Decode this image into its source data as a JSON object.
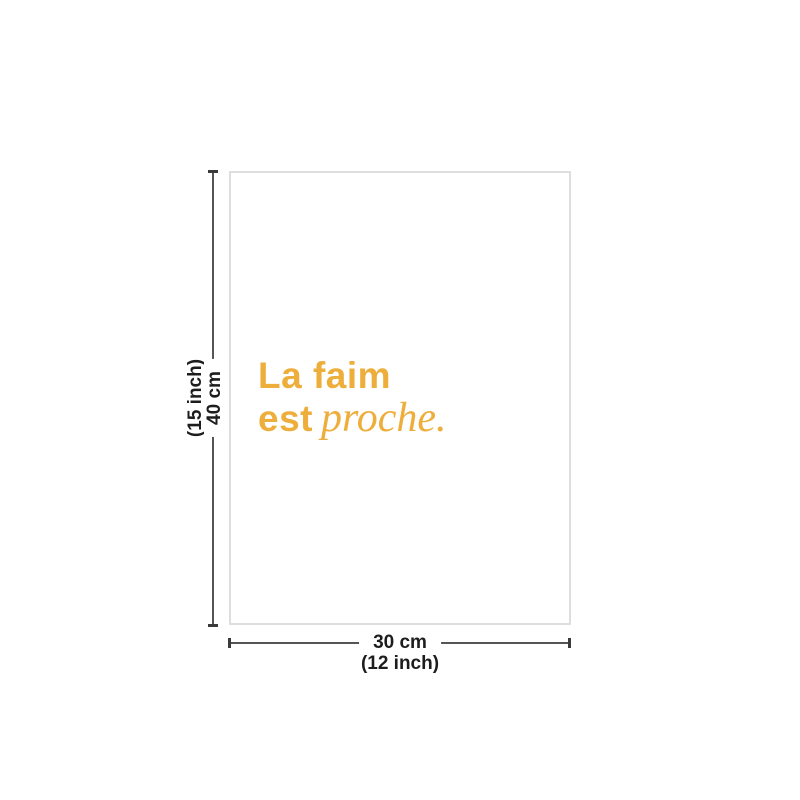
{
  "diagram": {
    "type": "product-size-diagram",
    "poster": {
      "quote_line1": "La faim",
      "quote_line2_bold": "est",
      "quote_line2_italic": "proche.",
      "accent_color": "#EDAE3B",
      "border_color": "#DEDEDE",
      "background_color": "#FFFFFF"
    },
    "height_dimension": {
      "value": "40 cm",
      "alt_value": "(15 inch)"
    },
    "width_dimension": {
      "value": "30 cm",
      "alt_value": "(12 inch)"
    },
    "measure_line_color": "#555555",
    "label_color": "#1D1D1D"
  }
}
